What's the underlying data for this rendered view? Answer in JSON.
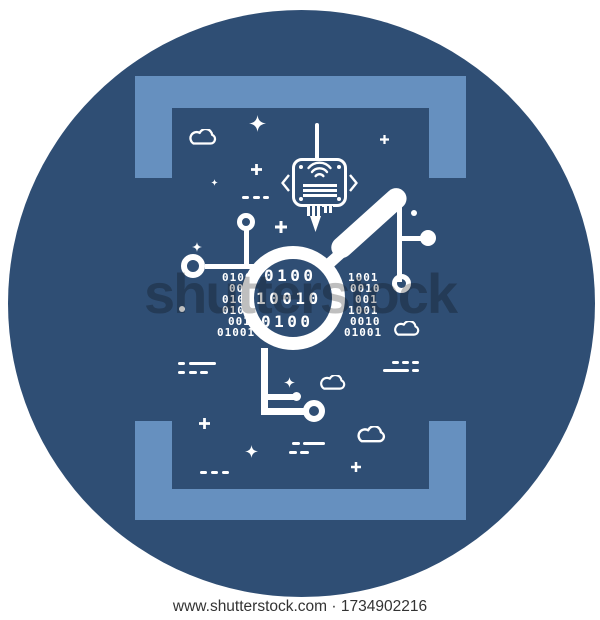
{
  "watermark": {
    "brand": "shutterstock",
    "caption": "www.shutterstock.com · 1734902216"
  },
  "colors": {
    "canvas_background": "#FFFFFF",
    "circle_background": "#2F4E74",
    "frame_bracket": "#6690BF",
    "line_art": "#FFFFFF",
    "watermark_text": "#BFBFBF",
    "caption_text": "#333333"
  },
  "illustration": {
    "lens_rows": [
      "0100",
      "10010",
      "0100"
    ],
    "binary_left": [
      "0100",
      "001",
      "010",
      "010",
      "001",
      "01001"
    ],
    "binary_right": [
      "1001",
      "0010",
      "001",
      "1001",
      "0010",
      "01001"
    ]
  }
}
